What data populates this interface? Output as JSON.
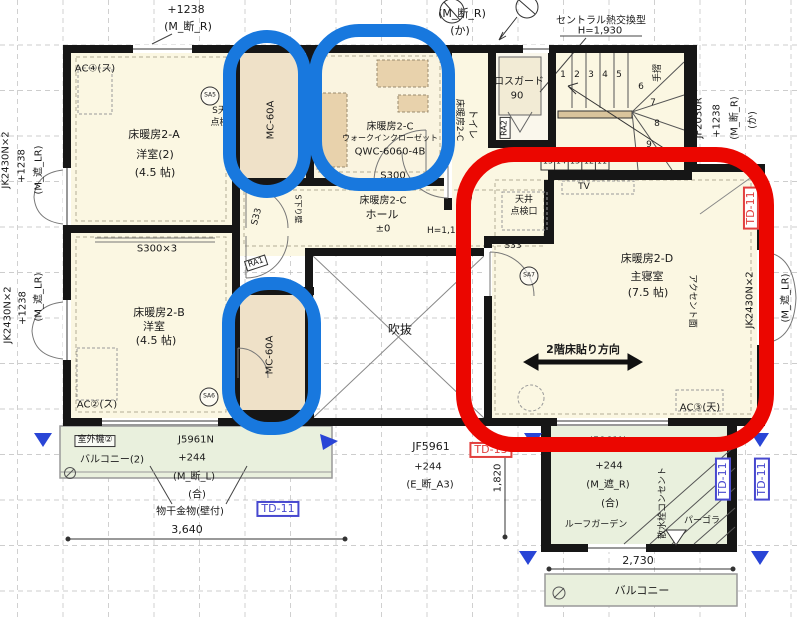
{
  "annotation_colors": {
    "circle_blue": "#1878DE",
    "circle_red": "#EB0600",
    "td_blue": "#4748CF",
    "td_red": "#E2403E"
  },
  "top": {
    "win_a_offset": "+1238",
    "win_a_type": "(M_断_R)",
    "win_b_type": "(M_断_R)",
    "win_b_kana": "(か)",
    "central_unit": "セントラル熱交換型",
    "central_height": "H=1,930"
  },
  "left_windows": {
    "w1_spec": "JK2430N×2",
    "w1_offset": "+1238",
    "w1_type": "(M_遮_LR)",
    "w2_spec": "JK2430N×2",
    "w2_offset": "+1238",
    "w2_type": "(M_遮_LR)"
  },
  "right_window": {
    "spec": "JK2430N×2",
    "offset": "+1238",
    "type": "(M_遮_LR)",
    "td": "TD-11"
  },
  "room_a": {
    "ac": "AC④(ス)",
    "sa": "SA5",
    "ceiling_1": "S天井",
    "ceiling_2": "点検口",
    "name": "床暖房2-A",
    "kind": "洋室(2)",
    "size": "(4.5 帖)"
  },
  "closet_top": {
    "label": "MC-60A"
  },
  "closet_bottom": {
    "label": "MC-60A"
  },
  "wic": {
    "name": "床暖房2-C",
    "kind": "ウォークインクローゼット",
    "model": "QWC-6060-4B",
    "sill": "S300"
  },
  "toilet": {
    "name": "床暖房2-C",
    "kind": "トイレ",
    "fan": "換"
  },
  "lossguard": {
    "name": "ロスガード",
    "num": "90",
    "ra": "RA2"
  },
  "stairs": {
    "handrail": "手摺",
    "n1": "1",
    "n2": "2",
    "n3": "3",
    "n4": "4",
    "n5": "5",
    "n6": "6",
    "n7": "7",
    "n8": "8",
    "n9": "9",
    "n10": "10",
    "b15": "15",
    "b14": "14",
    "b13": "13",
    "b12": "12",
    "b11": "11"
  },
  "stair_window": {
    "spec": "JF2030R",
    "offset": "+1238",
    "type": "(M_断_R)",
    "kana": "(か)"
  },
  "hall": {
    "name": "床暖房2-C",
    "kind": "ホール",
    "level": "±0",
    "height": "H=1,100",
    "drop_wall": "S下り壁",
    "s33": "S33",
    "ra": "RA1"
  },
  "void": {
    "label": "吹抜"
  },
  "bedroom": {
    "tv": "TV",
    "inspect_1": "天井",
    "inspect_2": "点検口",
    "s33": "S33",
    "sa": "SA7",
    "name": "床暖房2-D",
    "kind": "主寝室",
    "size": "(7.5 帖)",
    "accent": "アクセント面",
    "floor_dir": "2階床貼り方向",
    "ac": "AC③(天)",
    "td": "TD-11"
  },
  "room_b": {
    "shelf": "S300×3",
    "name": "床暖房2-B",
    "kind": "洋室",
    "size": "(4.5 帖)",
    "ac": "AC②(ス)",
    "sa": "SA6"
  },
  "balcony_left": {
    "unit": "室外機②",
    "name": "バルコニー(2)",
    "win_spec": "J5961N",
    "win_offset": "+244",
    "win_type": "(M_断_L)",
    "win_grade": "(合)",
    "hook": "物干金物(壁付)",
    "dim": "3,640",
    "td": "TD-11"
  },
  "roof_below": {
    "win_spec": "JF5961",
    "win_offset": "+244",
    "win_type": "(E_断_A3)",
    "td": "TD-13",
    "dim": "1,820"
  },
  "balcony_right": {
    "unit": "室外機③",
    "win_spec": "J5961N",
    "win_offset": "+244",
    "win_type": "(M_遮_R)",
    "win_grade": "(合)",
    "garden": "ルーフガーデン",
    "faucet": "散水栓コンセント",
    "pergola": "パーゴラ",
    "td_1": "TD-11",
    "td_2": "TD-11",
    "dim": "2,730",
    "name": "バルコニー"
  }
}
